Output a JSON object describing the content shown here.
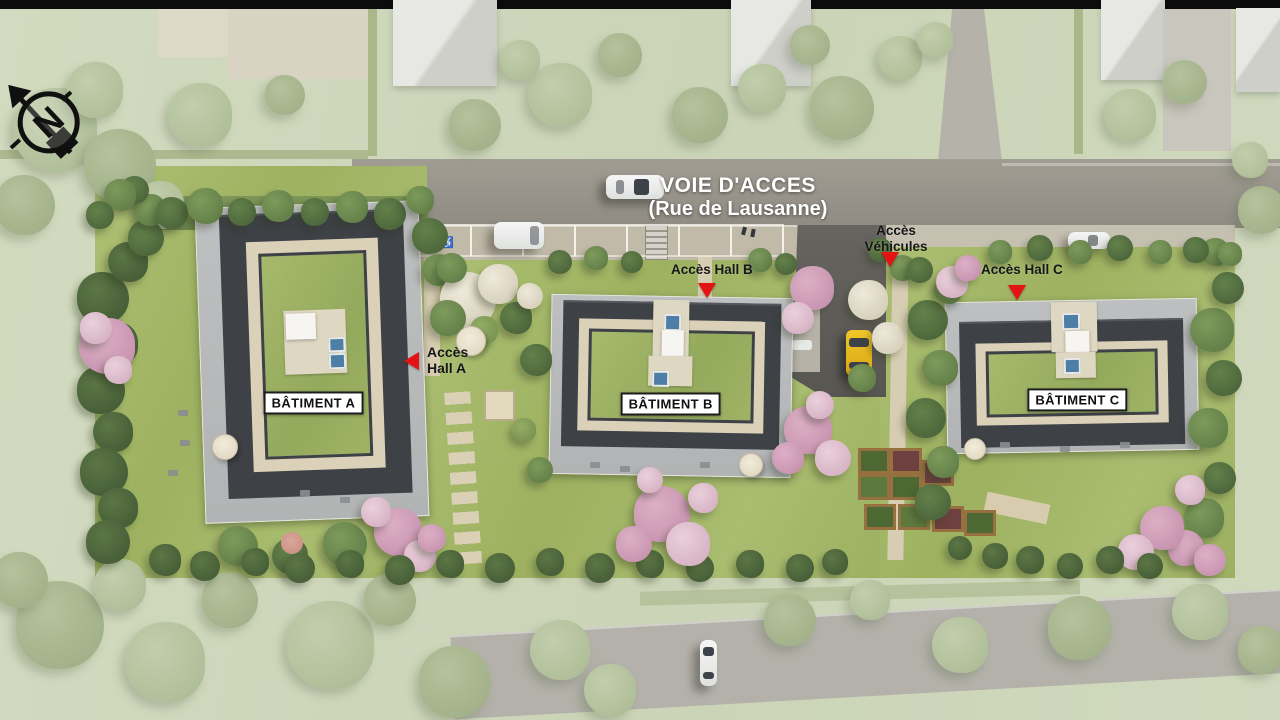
{
  "site_plan": {
    "north_indicator": "N",
    "main_road": {
      "label": "VOIE D'ACCES",
      "street_name": "(Rue de Lausanne)"
    },
    "buildings": [
      {
        "name": "BÂTIMENT A"
      },
      {
        "name": "BÂTIMENT B"
      },
      {
        "name": "BÂTIMENT C"
      }
    ],
    "access_labels": {
      "hall_a_line1": "Accès",
      "hall_a_line2": "Hall A",
      "hall_b": "Accès Hall B",
      "vehicles_line1": "Accès",
      "vehicles_line2": "Véhicules",
      "hall_c": "Accès Hall C"
    },
    "colors": {
      "arrow_red": "#e41414",
      "building_label_text": "#111111",
      "road_label_text": "#ffffff"
    }
  }
}
